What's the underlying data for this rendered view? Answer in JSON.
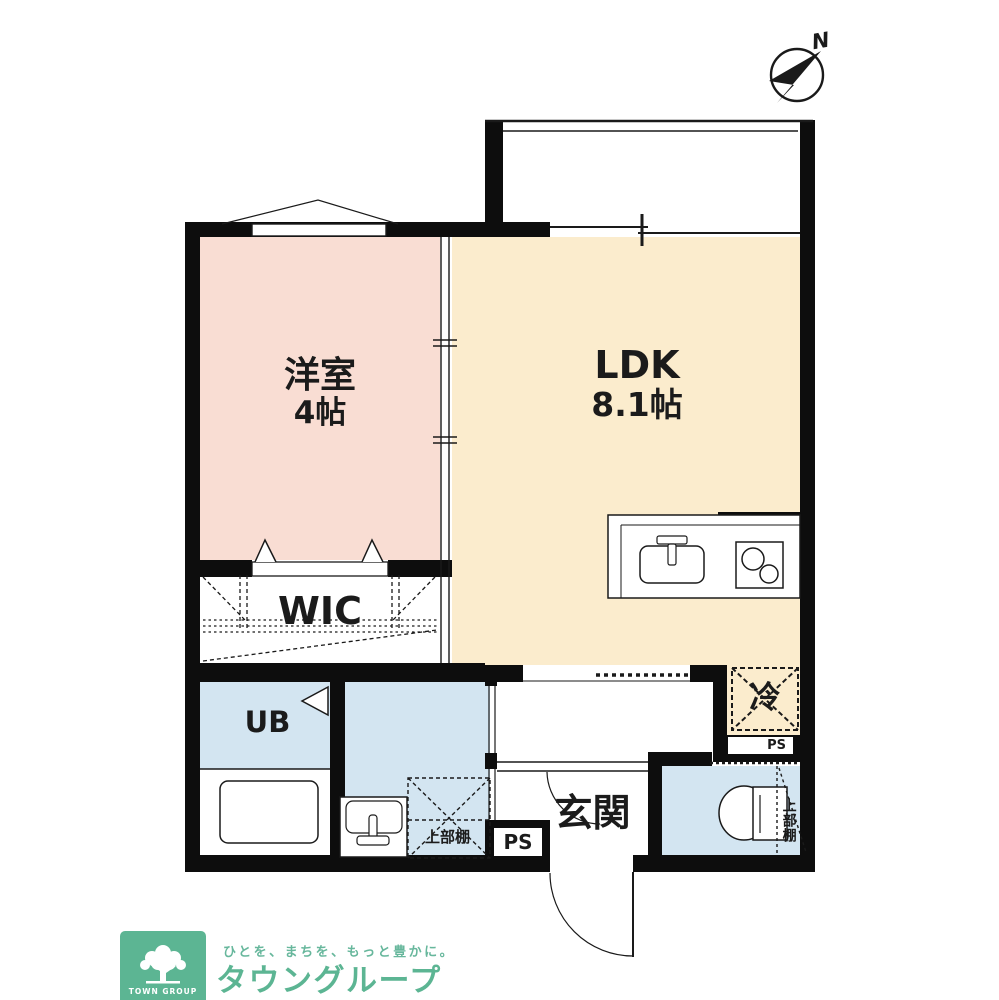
{
  "plan": {
    "bedroom": {
      "name": "洋室",
      "size": "4帖"
    },
    "ldk": {
      "name": "LDK",
      "size": "8.1帖"
    },
    "wic": "WIC",
    "bath": "UB",
    "entrance": "玄関",
    "fridge": "冷",
    "ps_nook": "PS",
    "ps_entrance": "PS",
    "shelf_washroom": "上部棚",
    "shelf_toilet": "上部棚",
    "compass_north": "N"
  },
  "footer": {
    "tagline": "ひとを、まちを、もっと豊かに。",
    "brand": "タウングループ",
    "logo_caption": "TOWN GROUP"
  },
  "colors": {
    "bedroom_fill": "#f9ddd3",
    "ldk_fill": "#fbeccd",
    "wet_area_fill": "#d3e5f1",
    "wall": "#0d0d0d",
    "brand_green": "#5cb593"
  }
}
